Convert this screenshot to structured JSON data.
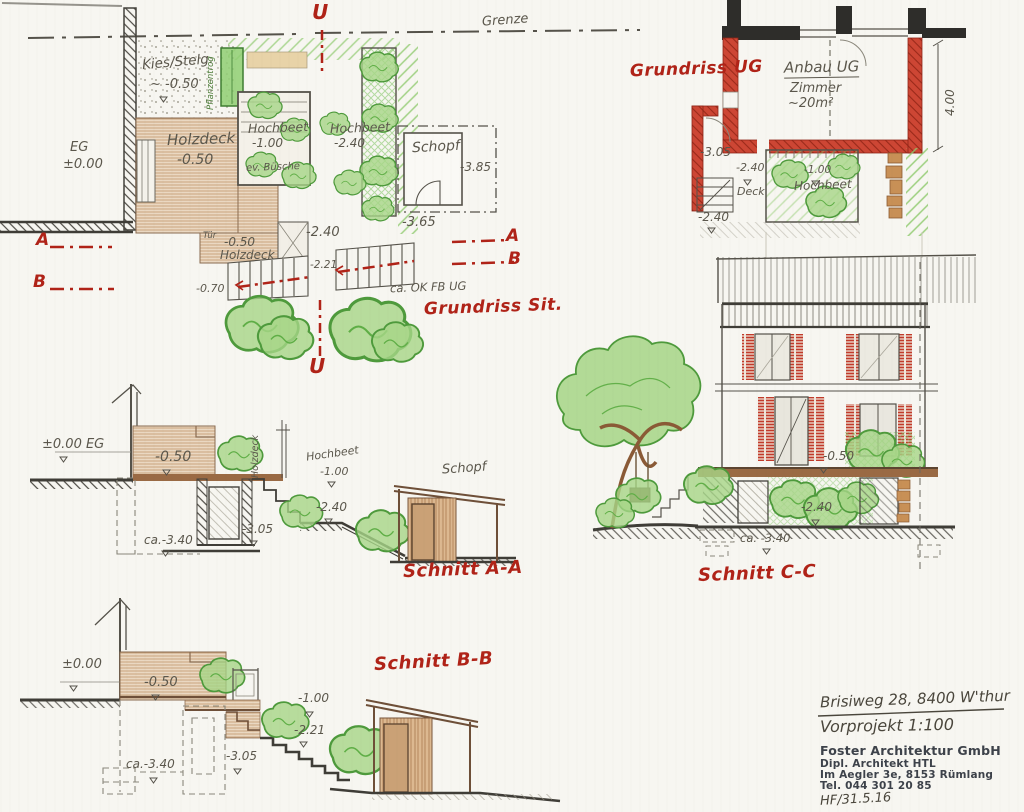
{
  "colors": {
    "paper": "#f7f6f1",
    "graphite": "#5b574c",
    "red_marker": "#b02318",
    "new_wall_red": "#cd4634",
    "vegetation_green": "#8cc96a",
    "wood_brown": "#c09468",
    "stamp_ink": "#3d424a"
  },
  "boundary": {
    "label": "Grenze"
  },
  "markers": {
    "u_top": "U",
    "u_bottom": "U",
    "a_left": "A",
    "a_right": "A",
    "b_left": "B",
    "b_right": "B"
  },
  "site_plan": {
    "title": "Grundriss Sit.",
    "kies": "Kies/Stelg.",
    "kies_level": "~ -0.50",
    "eg": "EG",
    "eg_level": "±0.00",
    "holzdeck": "Holzdeck",
    "holzdeck_level": "-0.50",
    "pflanzentrog": "Pflanzentrog",
    "hochbeet1": "Hochbeet",
    "hochbeet1_level": "-1.00",
    "hochbeet1_note": "ev. Büsche",
    "hochbeet2": "Hochbeet",
    "hochbeet2_level": "-2.40",
    "schopf": "Schopf",
    "schopf_level": "-3.85",
    "level_365": "-3.65",
    "level_240": "-2.40",
    "tuer": "Tür",
    "deck2_level": "-0.50",
    "deck2": "Holzdeck",
    "level_221": "-2.21",
    "level_070": "-0.70",
    "ok_fb": "ca. OK FB UG"
  },
  "grundriss_ug": {
    "title": "Grundriss UG",
    "anbau": "Anbau UG",
    "zimmer": "Zimmer",
    "zimmer_area": "~20m²",
    "dim_400": "4.00",
    "level_305": "-3.05",
    "level_240a": "-2.40",
    "deck": "Deck",
    "level_240b": "-2.40",
    "hochbeet_level": "-1.00",
    "hochbeet": "Hochbeet"
  },
  "schnitt_aa": {
    "title": "Schnitt A-A",
    "eg_level": "±0.00 EG",
    "deck_level": "-0.50",
    "holzdeck": "Holzdeck",
    "hochbeet": "Hochbeet",
    "hochbeet_level": "-1.00",
    "level_240": "-2.40",
    "level_305": "-3.05",
    "level_340": "ca.-3.40",
    "schopf": "Schopf"
  },
  "schnitt_cc": {
    "title": "Schnitt C-C",
    "level_050": "-0.50",
    "level_240": "-2.40",
    "level_340": "ca. -3.40"
  },
  "schnitt_bb": {
    "title": "Schnitt B-B",
    "level_000": "±0.00",
    "level_050": "-0.50",
    "level_100": "-1.00",
    "level_221": "-2.21",
    "level_305": "-3.05",
    "level_340": "ca.-3.40"
  },
  "title_block": {
    "address": "Brisiweg 28, 8400 W'thur",
    "project": "Vorprojekt 1:100",
    "firm": "Foster Architektur GmbH",
    "firm_line2": "Dipl. Architekt HTL",
    "firm_line3": "Im Aegler 3e, 8153 Rümlang",
    "firm_line4": "Tel. 044 301 20 85",
    "initials": "HF/31.5.16"
  }
}
